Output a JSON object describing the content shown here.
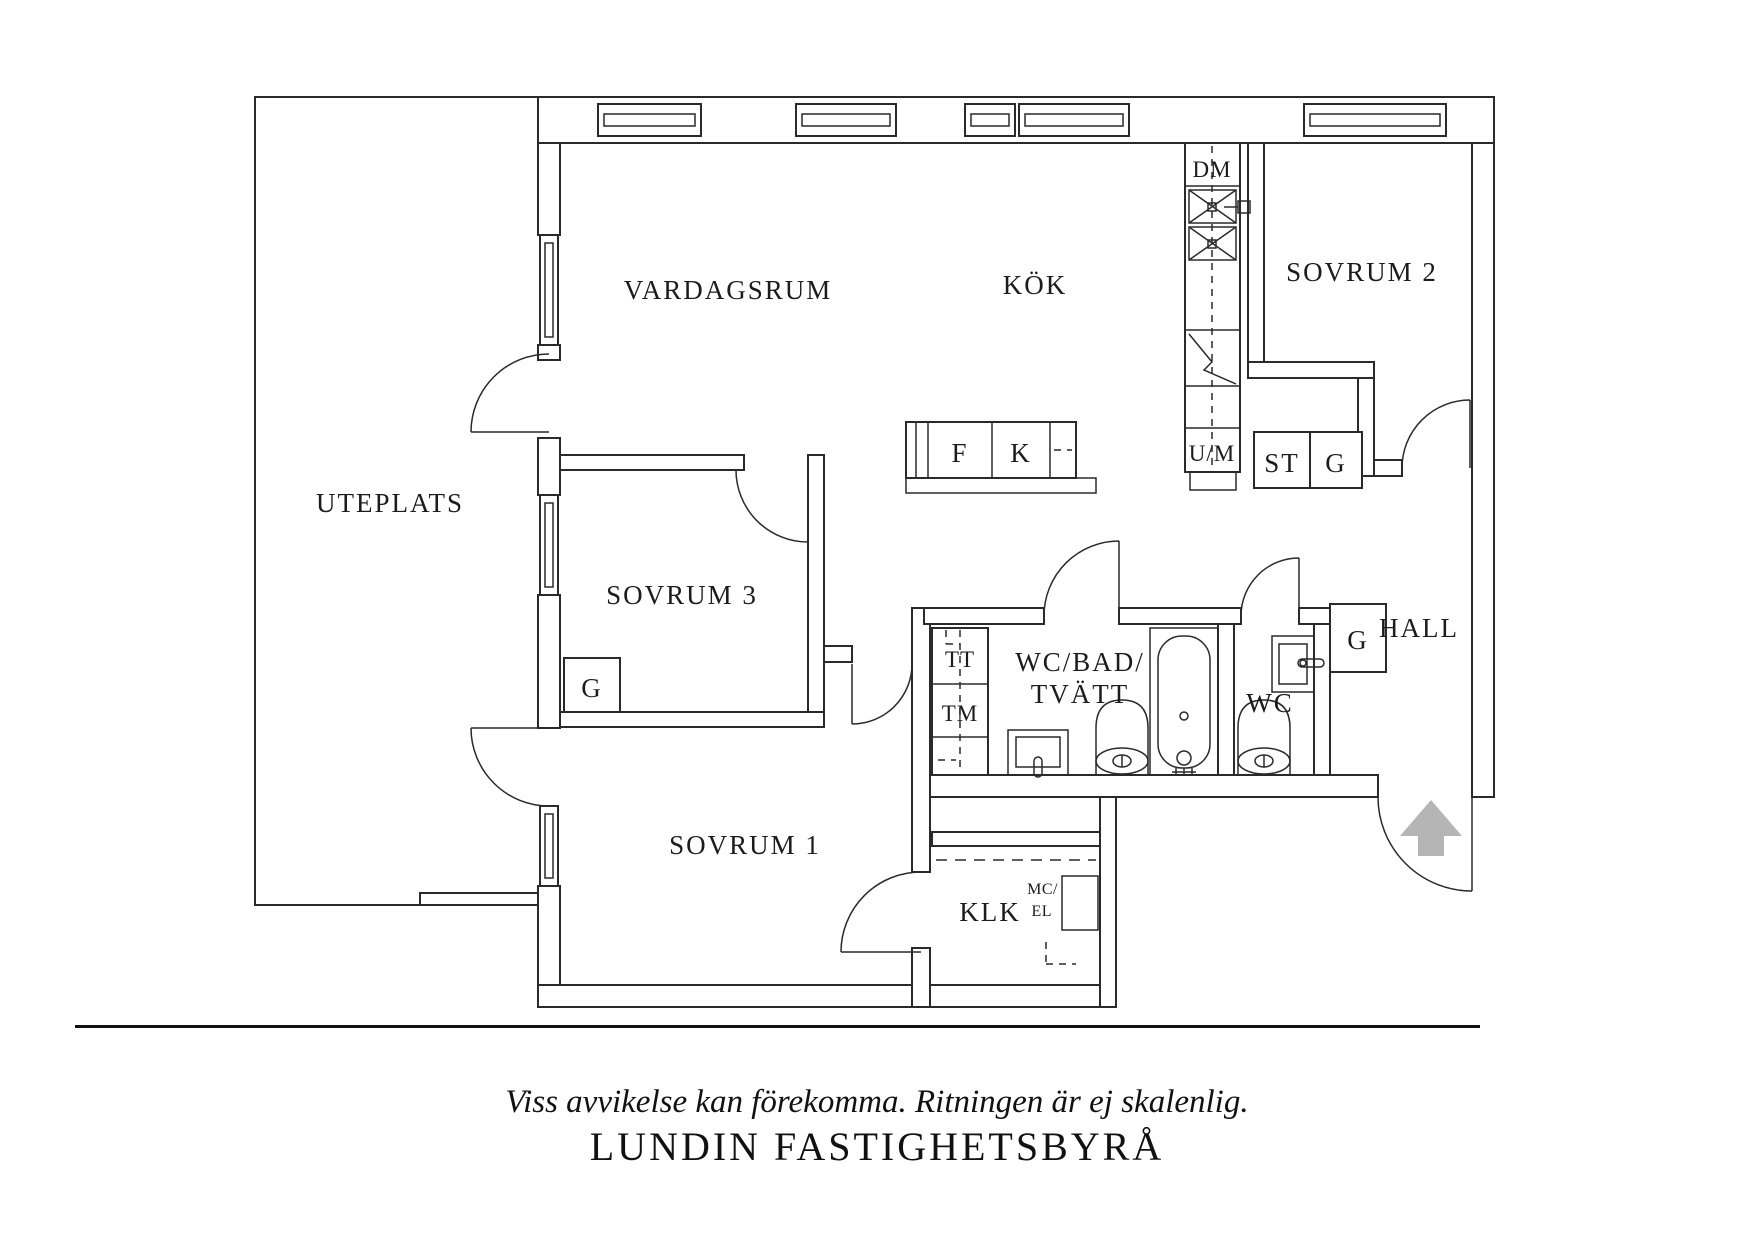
{
  "plan": {
    "room_labels": {
      "uteplats": "UTEPLATS",
      "vardagsrum": "VARDAGSRUM",
      "kok": "KÖK",
      "sovrum2": "SOVRUM 2",
      "sovrum3": "SOVRUM 3",
      "sovrum1": "SOVRUM 1",
      "klk": "KLK",
      "wc_bad_line1": "WC/BAD/",
      "wc_bad_line2": "TVÄTT",
      "wc": "WC",
      "hall": "HALL"
    },
    "fixture_labels": {
      "dm": "DM",
      "um": "U/M",
      "st": "ST",
      "g": "G",
      "tt": "TT",
      "tm": "TM",
      "f": "F",
      "k": "K",
      "mc": "MC/",
      "el": "EL"
    },
    "colors": {
      "line": "#2a2a2a",
      "arrow": "#b5b5b5"
    }
  },
  "footer": {
    "disclaimer": "Viss avvikelse kan förekomma. Ritningen är ej skalenlig.",
    "brand": "LUNDIN FASTIGHETSBYRÅ"
  }
}
